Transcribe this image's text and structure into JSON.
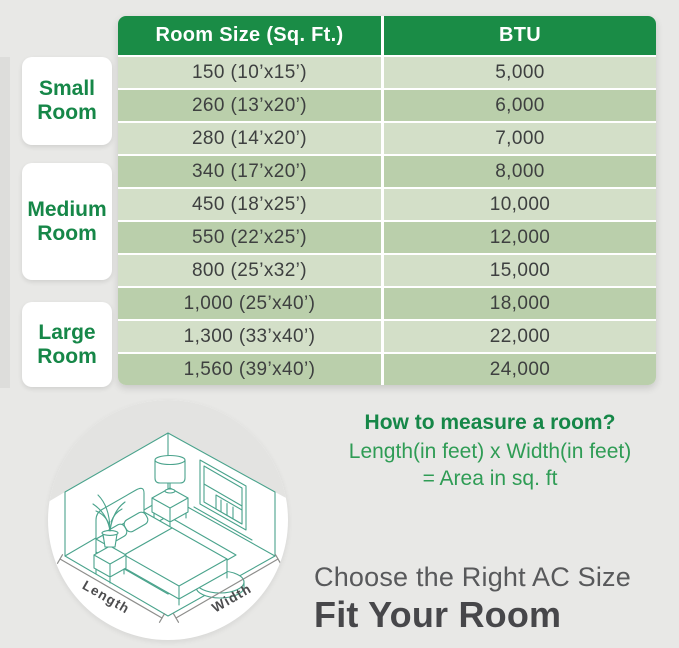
{
  "table": {
    "headers": [
      "Room Size (Sq. Ft.)",
      "BTU"
    ],
    "rows": [
      {
        "size": "150 (10’x15’)",
        "btu": "5,000"
      },
      {
        "size": "260 (13’x20’)",
        "btu": "6,000"
      },
      {
        "size": "280 (14’x20’)",
        "btu": "7,000"
      },
      {
        "size": "340 (17’x20’)",
        "btu": "8,000"
      },
      {
        "size": "450 (18’x25’)",
        "btu": "10,000"
      },
      {
        "size": "550 (22’x25’)",
        "btu": "12,000"
      },
      {
        "size": "800 (25’x32’)",
        "btu": "15,000"
      },
      {
        "size": "1,000 (25’x40’)",
        "btu": "18,000"
      },
      {
        "size": "1,300 (33’x40’)",
        "btu": "22,000"
      },
      {
        "size": "1,560 (39’x40’)",
        "btu": "24,000"
      }
    ]
  },
  "groups": [
    {
      "line1": "Small",
      "line2": "Room"
    },
    {
      "line1": "Medium",
      "line2": "Room"
    },
    {
      "line1": "Large",
      "line2": "Room"
    }
  ],
  "measure": {
    "title": "How to measure a room?",
    "line1": "Length(in feet) x Width(in feet)",
    "line2": "= Area in sq. ft"
  },
  "footer": {
    "subtitle": "Choose the Right AC Size",
    "title": "Fit Your Room"
  },
  "illustration": {
    "length_label": "Length",
    "width_label": "Width"
  },
  "colors": {
    "header_green": "#1a8c46",
    "row_light": "#d3dfc8",
    "row_dark": "#bacfab",
    "label_green": "#168748",
    "formula_green": "#2f9c55",
    "line_art_teal": "#4aa38c",
    "text_dark": "#3e4040",
    "footer_gray": "#58595b",
    "background": "#e8e8e6"
  }
}
